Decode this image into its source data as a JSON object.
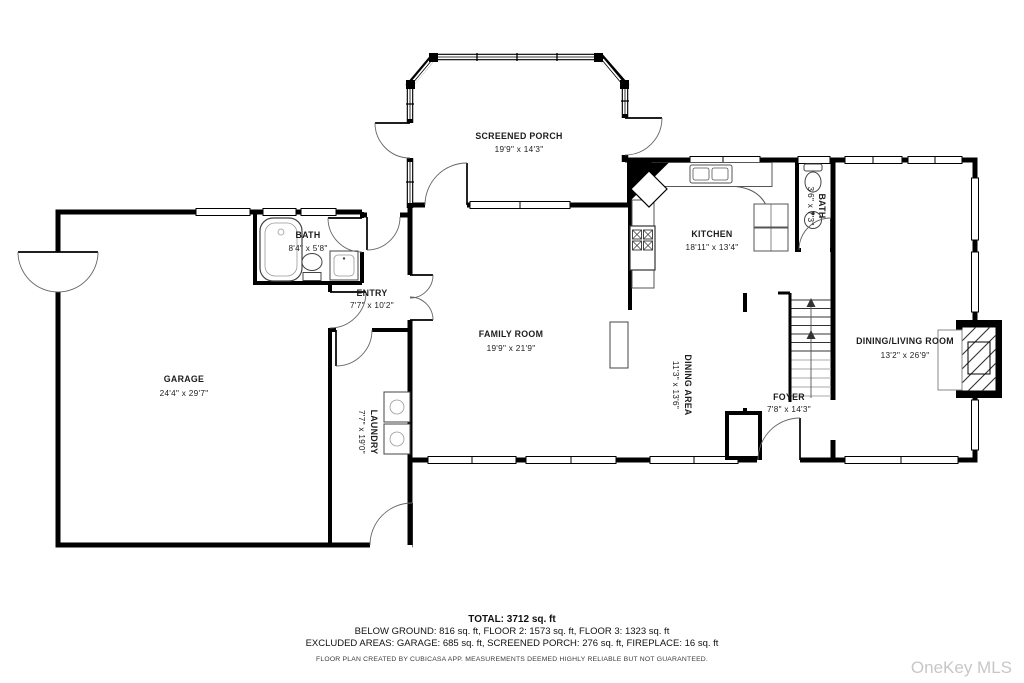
{
  "rooms": {
    "screened_porch": {
      "name": "SCREENED PORCH",
      "dims": "19'9\" x 14'3\""
    },
    "kitchen": {
      "name": "KITCHEN",
      "dims": "18'11\" x 13'4\""
    },
    "bath_upper": {
      "name": "BATH",
      "dims": "3'6\" x 7'3\""
    },
    "family_room": {
      "name": "FAMILY ROOM",
      "dims": "19'9\" x 21'9\""
    },
    "dining_area": {
      "name": "DINING AREA",
      "dims": "11'3\" x 13'6\""
    },
    "dining_living": {
      "name": "DINING/LIVING ROOM",
      "dims": "13'2\" x 26'9\""
    },
    "foyer": {
      "name": "FOYER",
      "dims": "7'8\" x 14'3\""
    },
    "entry": {
      "name": "ENTRY",
      "dims": "7'7\" x 10'2\""
    },
    "bath_left": {
      "name": "BATH",
      "dims": "8'4\" x 5'8\""
    },
    "garage": {
      "name": "GARAGE",
      "dims": "24'4\" x 29'7\""
    },
    "laundry": {
      "name": "LAUNDRY",
      "dims": "7'7\" x 19'0\""
    }
  },
  "footer": {
    "total": "TOTAL: 3712 sq. ft",
    "floors": "BELOW GROUND: 816 sq. ft, FLOOR 2: 1573 sq. ft, FLOOR 3: 1323 sq. ft",
    "excluded": "EXCLUDED AREAS: GARAGE: 685 sq. ft, SCREENED PORCH: 276 sq. ft, FIREPLACE: 16 sq. ft",
    "disclaimer": "FLOOR PLAN CREATED BY CUBICASA APP. MEASUREMENTS DEEMED HIGHLY RELIABLE BUT NOT GUARANTEED."
  },
  "watermark": "OneKey MLS",
  "colors": {
    "wall": "#000000",
    "label": "#1c1c1c",
    "watermark": "#c7c7c7"
  }
}
